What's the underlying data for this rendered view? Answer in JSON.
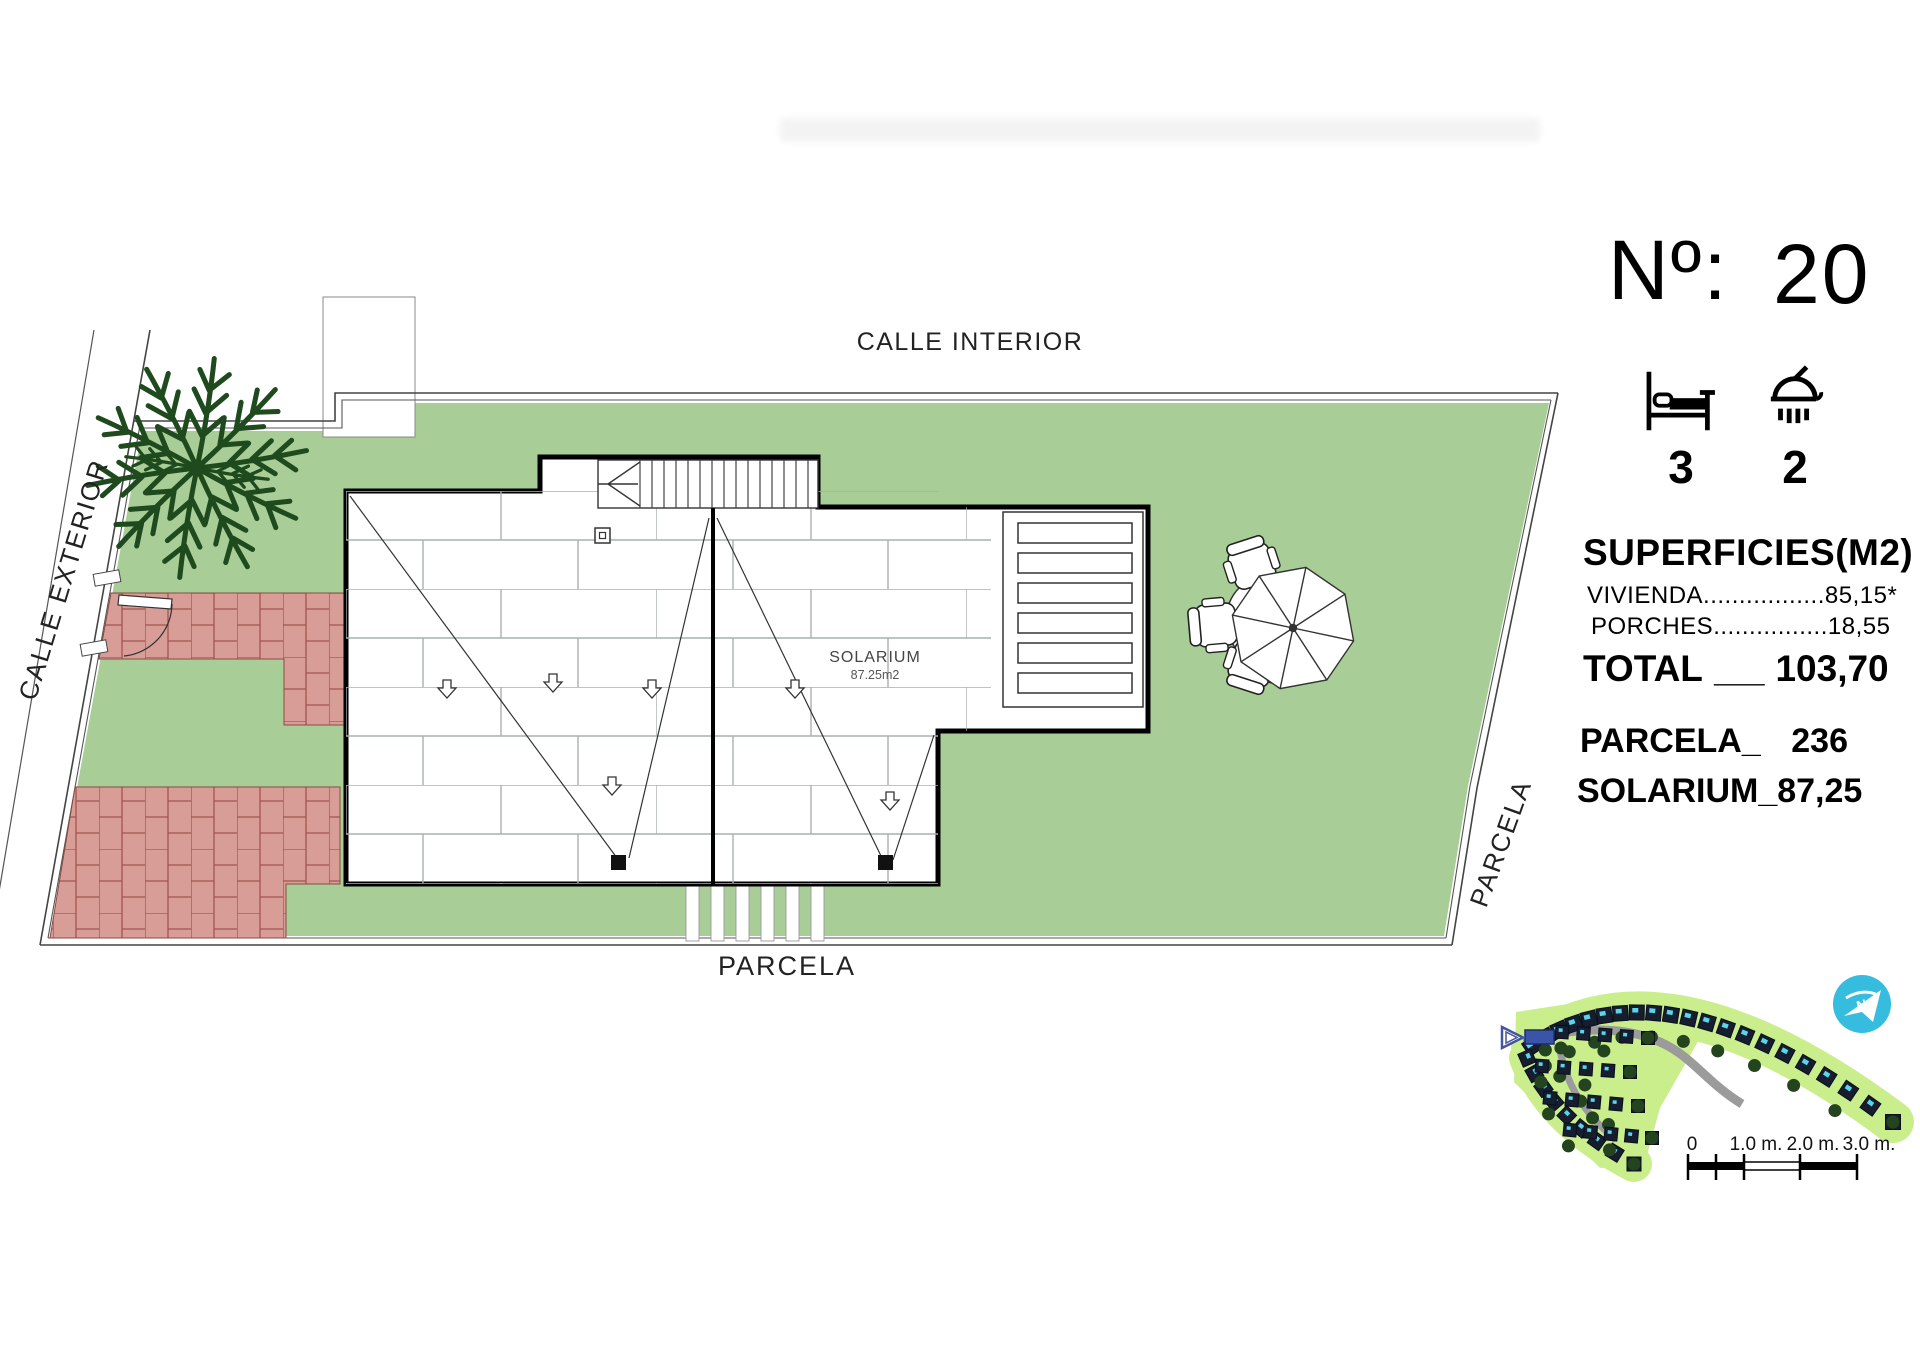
{
  "panel": {
    "number_label": "Nº:",
    "number_value": "20",
    "bedrooms_count": "3",
    "bathrooms_count": "2",
    "superficies_title": "SUPERFICIES(M2)",
    "vivienda_line": "VIVIENDA.................85,15*",
    "porches_line": "PORCHES................18,55",
    "total_label": "TOTAL",
    "total_sep": "_",
    "total_value": "103,70",
    "parcela_label": "PARCELA_",
    "parcela_value": "236",
    "solarium_label": "SOLARIUM_",
    "solarium_value": "87,25"
  },
  "plan": {
    "calle_interior": "CALLE INTERIOR",
    "calle_exterior": "CALLE EXTERIOR",
    "parcela_bottom": "PARCELA",
    "parcela_right": "PARCELA",
    "solarium_label": "SOLARIUM",
    "solarium_area": "87.25m2"
  },
  "minimap": {
    "north_label": "N"
  },
  "scale_bar": {
    "labels": [
      "0",
      "1.0 m.",
      "2.0 m.",
      "3.0 m."
    ]
  },
  "colors": {
    "parcel_green": "#a8cd96",
    "brick_fill": "#d89d97",
    "brick_line": "#a2554e",
    "minimap_green": "#cbee8d",
    "pool_cyan": "#59d6ea",
    "north_blue": "#35bcdf",
    "marker_blue": "#3a55a8"
  }
}
